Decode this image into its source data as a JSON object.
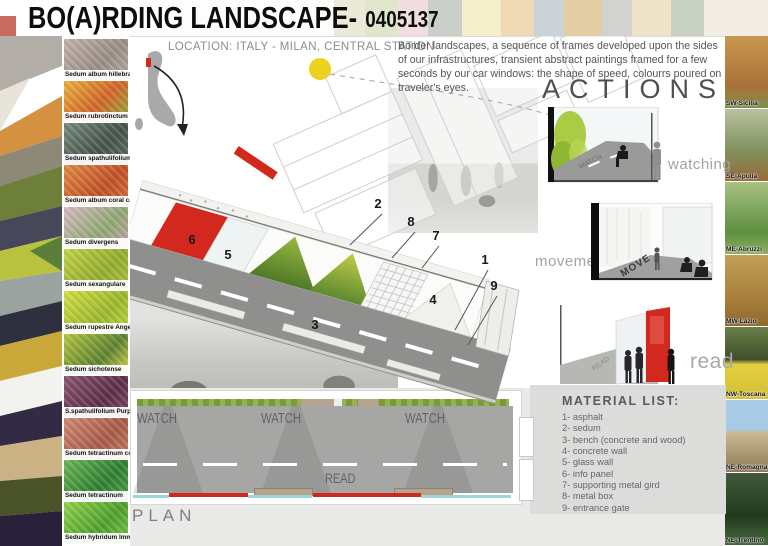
{
  "title": {
    "main": "BO(A)RDING LANDSCAPE-",
    "code": "0405137"
  },
  "location_label": "LOCATION: ITALY - MILAN, CENTRAL STATION",
  "description": "Border landscapes, a sequence of frames developed upon the sides of our infrastructures, transient abstract paintings framed for a few seconds by our car windows: the shape of speed, colourrs poured on traveler's eyes.",
  "sedum_panel": {
    "items": [
      {
        "label": "Sedum album hillebrandii"
      },
      {
        "label": "Sedum rubrotinctum"
      },
      {
        "label": "Sedum spathulifolium"
      },
      {
        "label": "Sedum album coral carpet"
      },
      {
        "label": "Sedum divergens"
      },
      {
        "label": "Sedum sexangulare"
      },
      {
        "label": "Sedum rupestre Angelina"
      },
      {
        "label": "Sedum sichotense"
      },
      {
        "label": "S.spathulifolium Purpureum"
      },
      {
        "label": "Sedum tetractinum coral Reef"
      },
      {
        "label": "Sedum tetractinum"
      },
      {
        "label": "Sedum hybridum Immergrünchen"
      }
    ]
  },
  "regions_panel": {
    "items": [
      {
        "label": "SW-Sicilia"
      },
      {
        "label": "SE-Apulia"
      },
      {
        "label": "ME-Abruzzi"
      },
      {
        "label": "MW-Lazio"
      },
      {
        "label": "NW-Toscana"
      },
      {
        "label": "NE-Romagna"
      },
      {
        "label": "NE-Trentino"
      }
    ]
  },
  "actions": {
    "heading": "ACTIONS",
    "items": [
      {
        "label": "watching",
        "ground_text": "WATCH"
      },
      {
        "label": "movement",
        "ground_text": "MOVE"
      },
      {
        "label": "read",
        "ground_text": "READ"
      }
    ]
  },
  "material_list": {
    "title": "MATERIAL LIST:",
    "items": [
      "1- asphalt",
      "2- sedum",
      "3- bench (concrete and wood)",
      "4- concrete wall",
      "5- glass wall",
      "6- info panel",
      "7- supporting metal gird",
      "8- metal box",
      "9- entrance gate"
    ]
  },
  "plan": {
    "label": "PLAN",
    "watch_labels": [
      "WATCH",
      "WATCH",
      "WATCH"
    ],
    "read_label": "READ"
  },
  "axon": {
    "callouts": [
      "1",
      "2",
      "3",
      "4",
      "5",
      "6",
      "7",
      "8",
      "9"
    ]
  },
  "colors": {
    "accent_red": "#d2281e",
    "sun_yellow": "#edd11f",
    "sedum_green": "#7a9a3c",
    "plan_cyan": "#9fd4d4"
  }
}
